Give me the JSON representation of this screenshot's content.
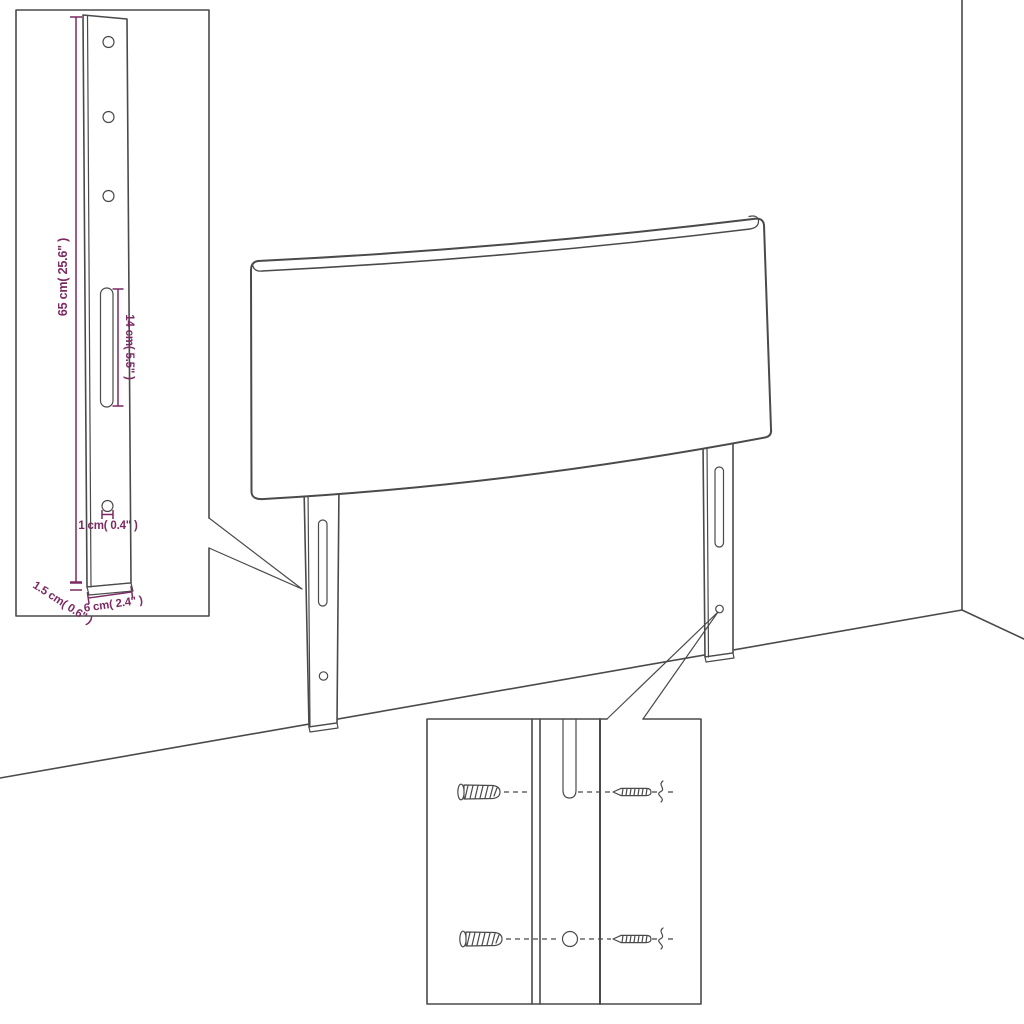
{
  "colors": {
    "line": "#4a4a4a",
    "dimension": "#7c2a63",
    "background": "#ffffff"
  },
  "leg_detail_inset": {
    "height_label": "65 cm( 25.6\" )",
    "slot_label": "14 cm( 5.5\" )",
    "hole_label": "1 cm( 0.4\" )",
    "foot_label": "1.5 cm( 0.6\" )",
    "width_label": "6 cm( 2.4\" )"
  },
  "hardware_inset": {
    "left_icons": [
      "wall-plug-icon",
      "wall-plug-icon"
    ],
    "right_icons": [
      "screw-icon",
      "screw-icon"
    ]
  }
}
